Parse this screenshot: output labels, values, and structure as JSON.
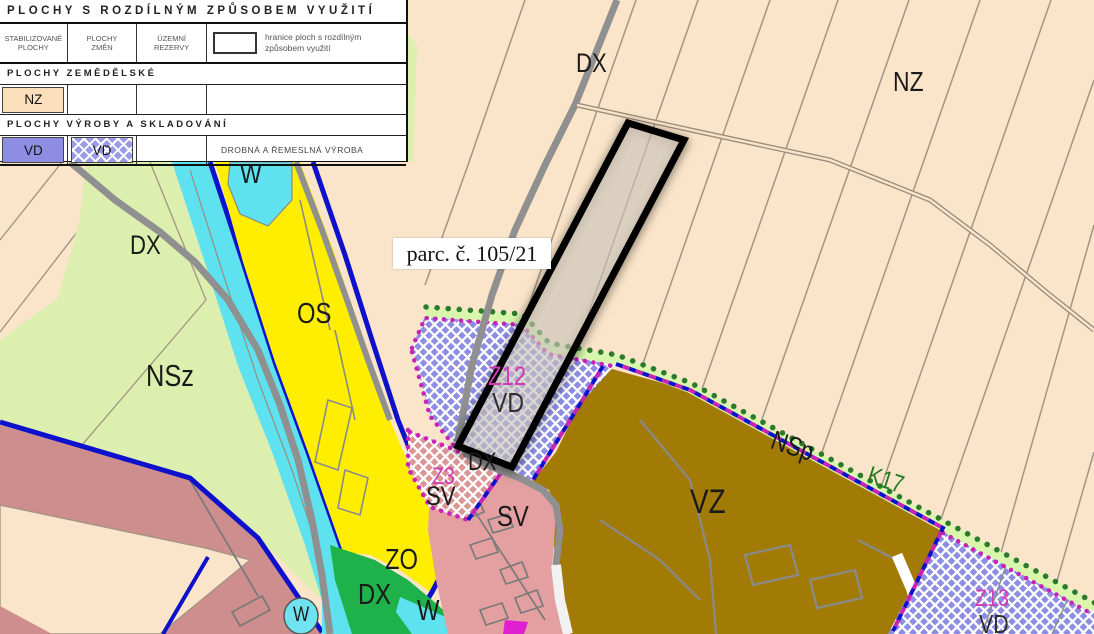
{
  "legend": {
    "title": "PLOCHY S ROZDÍLNÝM ZPŮSOBEM VYUŽITÍ",
    "columns": [
      "STABILIZOVANÉ\nPLOCHY",
      "PLOCHY\nZMĚN",
      "ÚZEMNÍ\nREZERVY"
    ],
    "boundary_note": "hranice ploch s rozdílným způsobem využití",
    "sections": [
      {
        "heading": "PLOCHY ZEMĚDĚLSKÉ",
        "rows": [
          {
            "stabilized": "NZ",
            "changes": "",
            "reserve": "",
            "description": ""
          }
        ]
      },
      {
        "heading": "PLOCHY VÝROBY A SKLADOVÁNÍ",
        "rows": [
          {
            "stabilized": "VD",
            "changes": "VD",
            "reserve": "",
            "description": "DROBNÁ A ŘEMESLNÁ VÝROBA"
          }
        ]
      }
    ]
  },
  "map": {
    "parcel_label": "parc. č. 105/21",
    "labels": [
      {
        "text": "DX"
      },
      {
        "text": "NZ"
      },
      {
        "text": "DX"
      },
      {
        "text": "W"
      },
      {
        "text": "OS"
      },
      {
        "text": "NSz"
      },
      {
        "text": "Z12"
      },
      {
        "text": "VD"
      },
      {
        "text": "Z3"
      },
      {
        "text": "SV"
      },
      {
        "text": "SV"
      },
      {
        "text": "DX"
      },
      {
        "text": "ZO"
      },
      {
        "text": "DX"
      },
      {
        "text": "W"
      },
      {
        "text": "W"
      },
      {
        "text": "VZ"
      },
      {
        "text": "NSp"
      },
      {
        "text": "K17"
      },
      {
        "text": "Z13"
      },
      {
        "text": "VD"
      }
    ],
    "colors": {
      "nz_agricultural": "#fbe5ca",
      "nsz_landscape_green": "#dcefae",
      "os_sport_yellow": "#ffee00",
      "water_cyan": "#5ee2f0",
      "sv_mixed_pink": "#e4a0a0",
      "sv_mixed_rose": "#cf8e8e",
      "vz_agri_production_brown": "#a27a06",
      "vd_production_purple": "#8d8de4",
      "zo_green": "#1fb14a",
      "boundary_blue": "#0e11cc",
      "change_boundary_magenta": "#c723b4",
      "nature_dots_green": "#2c7a2c",
      "parcel_outline_black": "#000000"
    }
  }
}
